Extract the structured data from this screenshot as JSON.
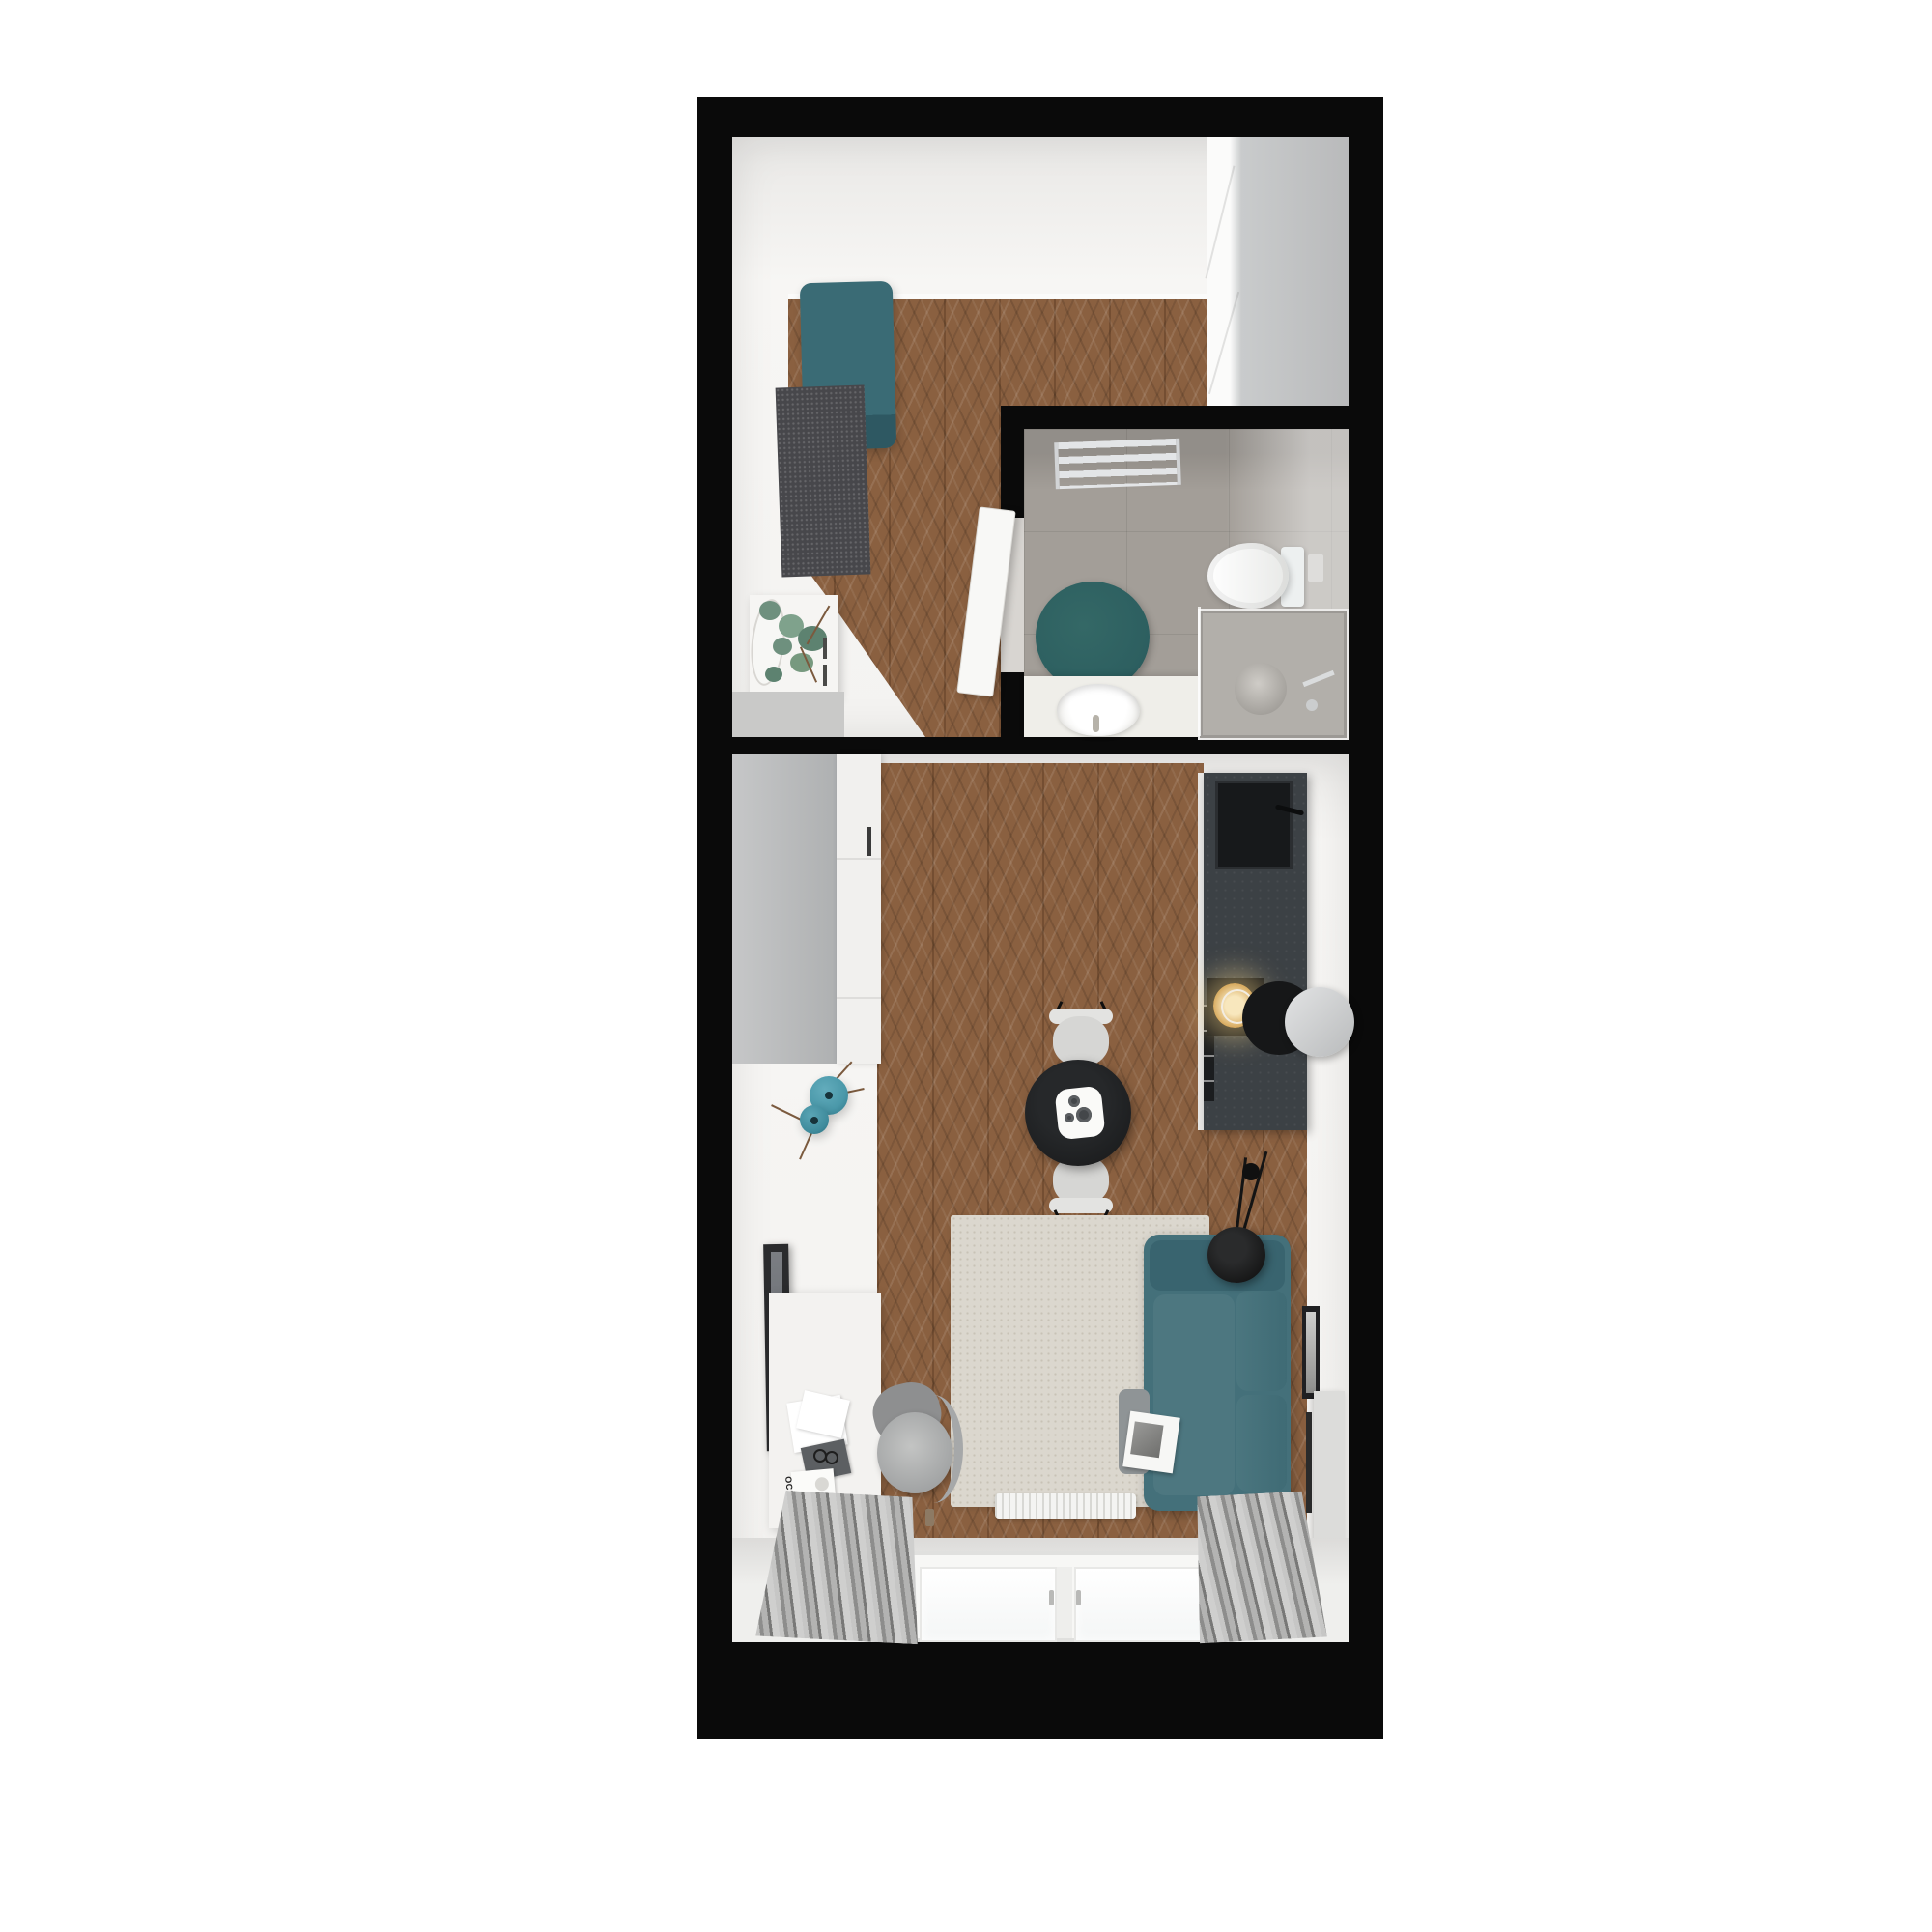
{
  "scene": {
    "type": "3d-floor-plan-render",
    "description": "Top-down 3D render of a small studio apartment with entry hall, bathroom and combined living room / kitchen",
    "rooms": [
      {
        "id": "hall",
        "label": "entry hall"
      },
      {
        "id": "bathroom",
        "label": "bathroom"
      },
      {
        "id": "living",
        "label": "living room with kitchenette"
      }
    ],
    "inventory": {
      "hall": [
        "teal-ottoman",
        "dark-gray-rug",
        "console-with-plant",
        "oval-mirror",
        "entry-mat",
        "wardrobe"
      ],
      "bathroom": [
        "towel-radiator",
        "toilet",
        "round-teal-rug",
        "vanity-with-basin",
        "shower-enclosure",
        "open-door"
      ],
      "living": [
        "gray-wardrobe",
        "white-cabinet",
        "kitchen-counter",
        "black-sink",
        "induction-hob",
        "cooker-hood",
        "dining-table",
        "two-chairs",
        "teal-sofa",
        "cream-rug",
        "floor-lamp",
        "tv",
        "desk",
        "office-chair",
        "teal-vases",
        "radiator",
        "window",
        "curtains",
        "wall-frames"
      ]
    }
  },
  "texts": {
    "magazine_title": "OC!"
  },
  "colors": {
    "wall": "#0a0a0a",
    "page": "#ffffff",
    "room_white": "#f4f3f1",
    "wood": "#8a6040",
    "tile": "#a39e98",
    "counter": "#3c4145",
    "sink_black": "#17191b",
    "teal_sofa": "#44707a",
    "teal_sofa_dark": "#39646f",
    "teal_ottoman": "#3a6b75",
    "teal_ottoman_dark": "#2e5862",
    "teal_rug": "#2d5f60",
    "teal_vase": "#4a98a9",
    "rug_cream": "#dbd7ce",
    "rug_dark": "#47474b",
    "curtain_a": "#c6c6c5",
    "curtain_b": "#8d8d8c",
    "curtain_c": "#787877",
    "gray_cabinet": "#b9babb",
    "white_cab": "#f1f0ee",
    "chair_gray": "#d6d6d4",
    "office_chair": "#a9abab",
    "lamp_black": "#161718",
    "plant_green": "#6e907e",
    "branch": "#7b5a3e",
    "glow": "#f3d9a8"
  }
}
